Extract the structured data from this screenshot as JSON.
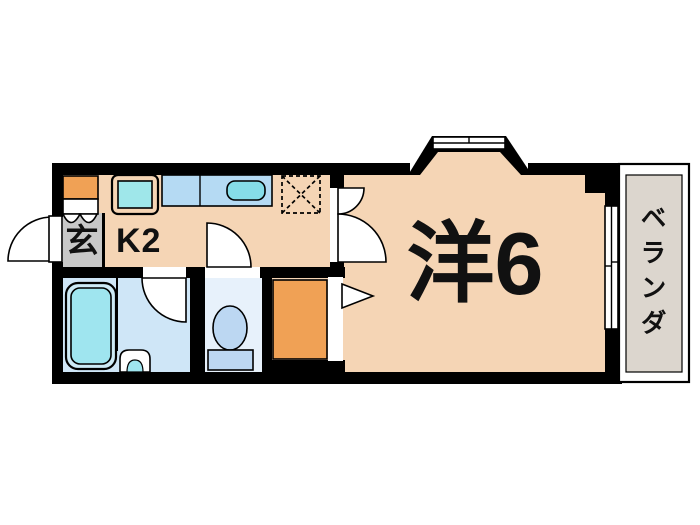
{
  "floorplan": {
    "type": "japanese-apartment-floor-plan",
    "labels": {
      "entrance": "玄",
      "kitchen": "K2",
      "western_room": "洋6",
      "balcony": "ベランダ"
    },
    "colors": {
      "wall": "#000000",
      "background": "#ffffff",
      "floor_wood": "#f5d5b5",
      "entrance_floor": "#c8c8c8",
      "kitchen_counter": "#b5daf3",
      "kitchen_sink": "#86dde8",
      "stove_top": "#9fe7ea",
      "bathroom_floor": "#cfe6f7",
      "bathtub": "#9fe5ef",
      "bathtub_rim": "#cdeaf6",
      "toilet_floor": "#e7f1fb",
      "toilet_fixture": "#bcd7f2",
      "storage_accent": "#f0a155",
      "balcony_floor": "#dcd6ce",
      "door_fill": "#ffffff"
    }
  }
}
